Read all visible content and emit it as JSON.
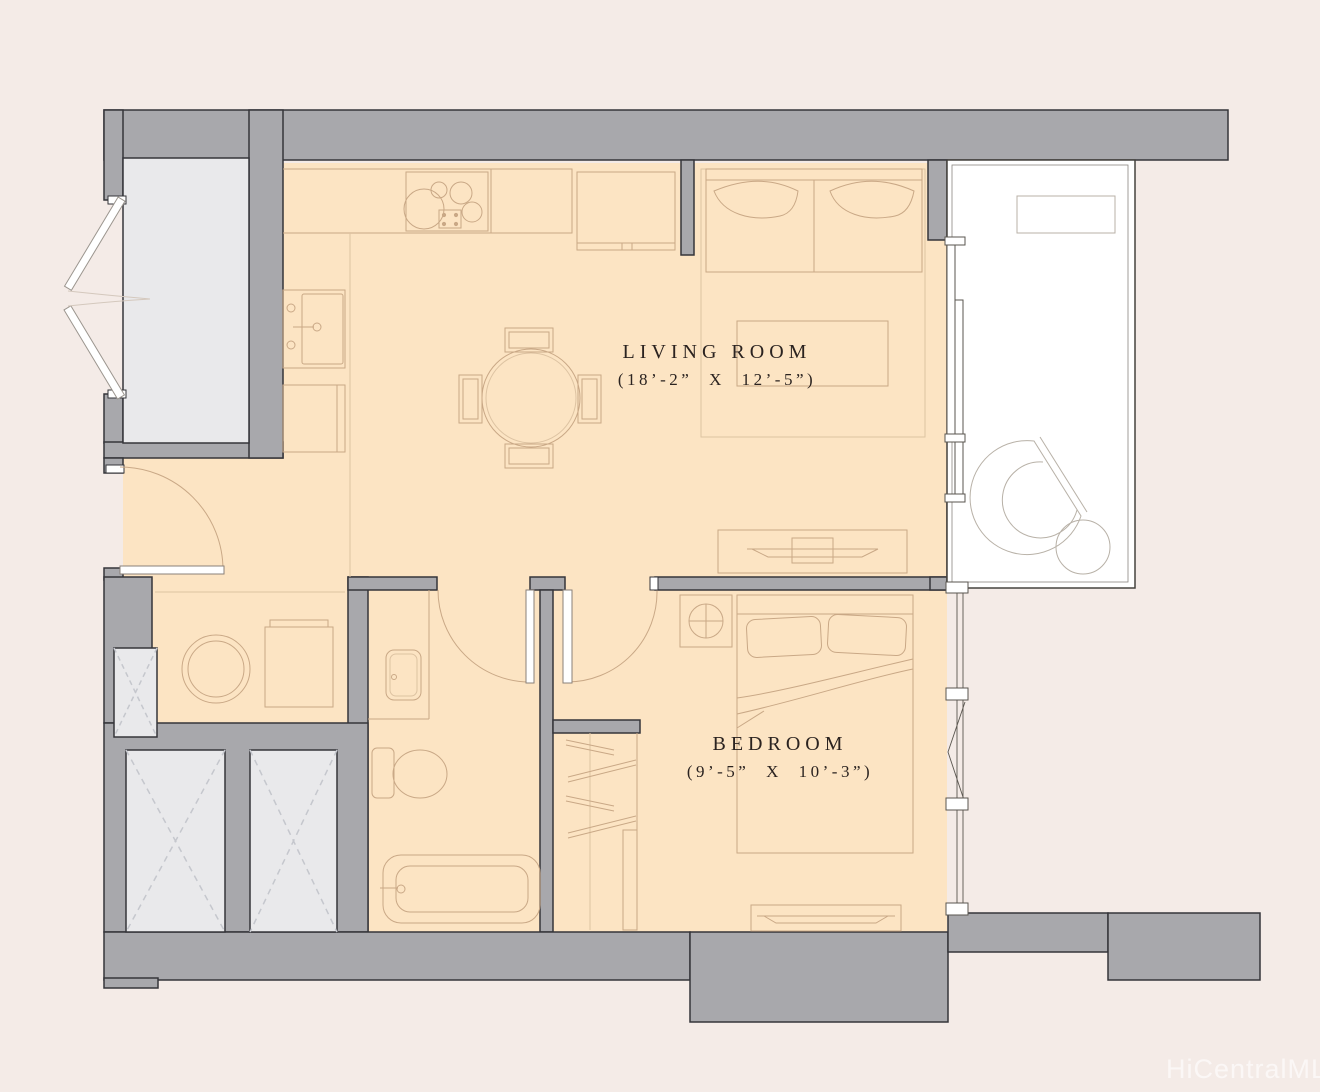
{
  "floorplan": {
    "watermark": "HiCentralMLS",
    "rooms": [
      {
        "name": "LIVING ROOM",
        "dimensions": "(18’-2” X 12’-5”)"
      },
      {
        "name": "BEDROOM",
        "dimensions": "(9’-5” X 10’-3”)"
      }
    ],
    "colors": {
      "background": "#f4ebe7",
      "wall_fill": "#a8a8ac",
      "wall_outline": "#35353a",
      "floor_fill": "#fce4c3",
      "furniture_line": "#c9a886",
      "shaft_fill": "#e9e9eb",
      "shaft_dash": "#c5c7cd",
      "glass_line": "#5a564f",
      "lanai_fill": "#ffffff",
      "label_text": "#2b2320",
      "watermark_text": "#ffffff"
    }
  }
}
